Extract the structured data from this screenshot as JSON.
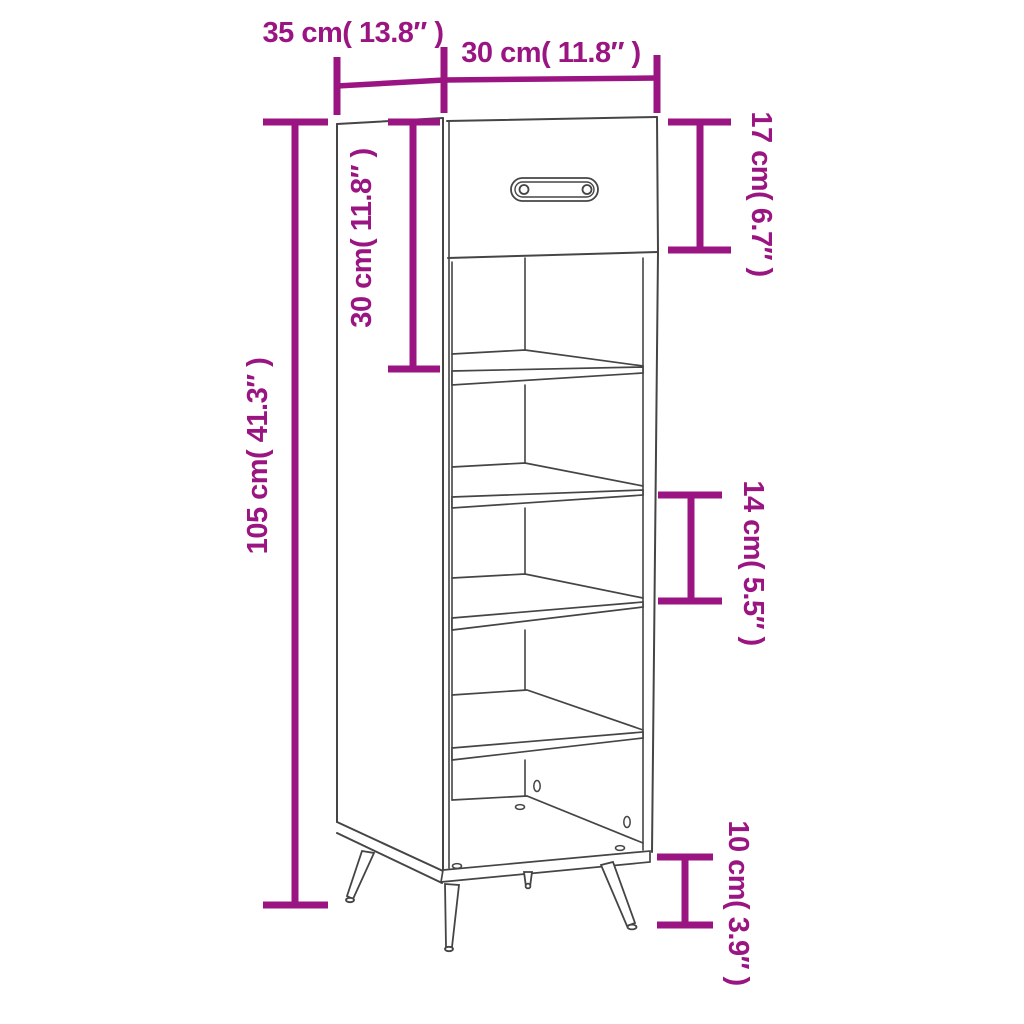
{
  "figure": {
    "name": "shoe-cabinet-dimension-diagram",
    "colors": {
      "dimension_accent": "#9A1582",
      "drawing_outline": "#454545",
      "background": "#FFFFFF"
    },
    "annotations": {
      "top_depth": "35 cm( 13.8″ )",
      "top_width": "30 cm( 11.8″ )",
      "drawer_height": "17 cm( 6.7″ )",
      "upper_compartment_height": "30 cm( 11.8″ )",
      "overall_height": "105 cm( 41.3″ )",
      "shelf_gap": "14 cm( 5.5″ )",
      "legs_height": "10 cm( 3.9″ )"
    },
    "parts": {
      "drawer_count": 1,
      "shelf_count": 4,
      "leg_count": 4
    }
  }
}
